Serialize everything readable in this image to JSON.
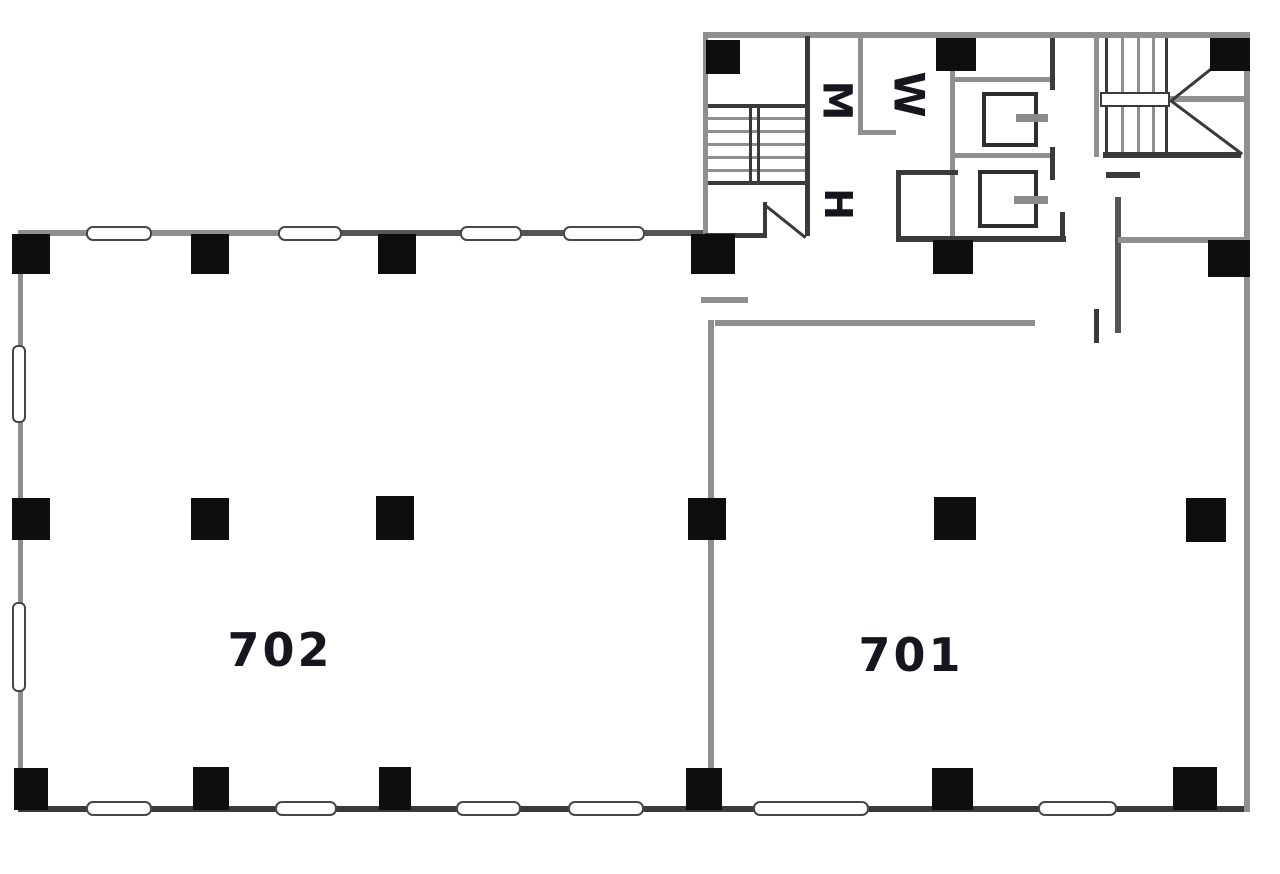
{
  "title": "Office floor plan — 7th floor",
  "rooms": {
    "left_room_label": "702",
    "right_room_label": "701",
    "mens_room_label": "M",
    "womens_room_label": "W",
    "utility_room_label": "H"
  },
  "colors": {
    "background": "#ffffff",
    "column_black": "#0e0e0e",
    "g": "#8f8f8f",
    "m": "#555555",
    "d": "#3a3a3a",
    "text": "#16161f"
  },
  "plan": {
    "walls": [
      [
        18,
        230,
        326,
        6,
        "g"
      ],
      [
        340,
        230,
        368,
        6,
        "m"
      ],
      [
        703,
        32,
        547,
        6,
        "g"
      ],
      [
        18,
        232,
        5,
        580,
        "g"
      ],
      [
        18,
        806,
        1232,
        6,
        "d"
      ],
      [
        1244,
        34,
        6,
        778,
        "g"
      ],
      [
        703,
        36,
        5,
        202,
        "g"
      ],
      [
        805,
        36,
        5,
        200,
        "d"
      ],
      [
        705,
        233,
        62,
        5,
        "d"
      ],
      [
        708,
        104,
        97,
        4,
        "d"
      ],
      [
        708,
        117,
        97,
        3,
        "g"
      ],
      [
        708,
        130,
        97,
        3,
        "g"
      ],
      [
        708,
        143,
        97,
        3,
        "g"
      ],
      [
        708,
        156,
        97,
        3,
        "g"
      ],
      [
        708,
        169,
        97,
        3,
        "g"
      ],
      [
        708,
        181,
        97,
        4,
        "d"
      ],
      [
        749,
        104,
        3,
        81,
        "d"
      ],
      [
        757,
        104,
        3,
        81,
        "d"
      ],
      [
        763,
        202,
        4,
        36,
        "d"
      ],
      [
        858,
        37,
        5,
        98,
        "g"
      ],
      [
        858,
        130,
        38,
        5,
        "g"
      ],
      [
        950,
        70,
        5,
        170,
        "g"
      ],
      [
        955,
        77,
        98,
        5,
        "g"
      ],
      [
        1050,
        38,
        5,
        52,
        "d"
      ],
      [
        955,
        153,
        98,
        5,
        "g"
      ],
      [
        1050,
        147,
        5,
        33,
        "d"
      ],
      [
        896,
        170,
        62,
        5,
        "d"
      ],
      [
        896,
        170,
        5,
        72,
        "d"
      ],
      [
        896,
        236,
        170,
        6,
        "d"
      ],
      [
        1060,
        212,
        5,
        30,
        "d"
      ],
      [
        1094,
        35,
        5,
        122,
        "g"
      ],
      [
        1105,
        38,
        3,
        116,
        "d"
      ],
      [
        1121,
        38,
        3,
        116,
        "g"
      ],
      [
        1137,
        38,
        3,
        116,
        "g"
      ],
      [
        1152,
        38,
        3,
        116,
        "g"
      ],
      [
        1165,
        38,
        3,
        116,
        "d"
      ],
      [
        1170,
        96,
        76,
        6,
        "g"
      ],
      [
        1103,
        152,
        138,
        6,
        "d"
      ],
      [
        1106,
        172,
        34,
        6,
        "d"
      ],
      [
        1115,
        197,
        6,
        136,
        "m"
      ],
      [
        1118,
        237,
        128,
        6,
        "g"
      ],
      [
        1094,
        309,
        5,
        34,
        "d"
      ],
      [
        715,
        320,
        320,
        6,
        "g"
      ],
      [
        708,
        320,
        6,
        452,
        "g"
      ],
      [
        701,
        297,
        47,
        6,
        "g"
      ]
    ],
    "columns": [
      [
        12,
        234,
        38,
        40
      ],
      [
        191,
        234,
        38,
        40
      ],
      [
        378,
        234,
        38,
        40
      ],
      [
        691,
        234,
        44,
        40
      ],
      [
        933,
        240,
        40,
        34
      ],
      [
        1208,
        240,
        42,
        37
      ],
      [
        12,
        498,
        38,
        42
      ],
      [
        191,
        498,
        38,
        42
      ],
      [
        376,
        496,
        38,
        44
      ],
      [
        688,
        498,
        38,
        42
      ],
      [
        934,
        497,
        42,
        43
      ],
      [
        1186,
        498,
        40,
        44
      ],
      [
        14,
        768,
        34,
        42
      ],
      [
        193,
        767,
        36,
        43
      ],
      [
        379,
        767,
        32,
        43
      ],
      [
        686,
        768,
        36,
        42
      ],
      [
        932,
        768,
        41,
        42
      ],
      [
        1173,
        767,
        44,
        43
      ],
      [
        706,
        40,
        34,
        34
      ],
      [
        936,
        38,
        40,
        33
      ],
      [
        1210,
        38,
        40,
        33
      ]
    ],
    "windows_h": [
      [
        86,
        226,
        62
      ],
      [
        278,
        226,
        60
      ],
      [
        460,
        226,
        58
      ],
      [
        563,
        226,
        78
      ],
      [
        86,
        801,
        62
      ],
      [
        275,
        801,
        58
      ],
      [
        456,
        801,
        61
      ],
      [
        568,
        801,
        72
      ],
      [
        753,
        801,
        112
      ],
      [
        1038,
        801,
        75
      ]
    ],
    "windows_v": [
      [
        12,
        345,
        74
      ],
      [
        12,
        602,
        86
      ]
    ],
    "stalls": [
      [
        982,
        92,
        48,
        47
      ],
      [
        978,
        170,
        52,
        50
      ]
    ],
    "fixtures": [
      [
        1016,
        114,
        32,
        8
      ],
      [
        1014,
        196,
        34,
        8
      ]
    ],
    "landing": [
      1100,
      92,
      66,
      11
    ],
    "diagonals": [
      [
        766,
        204,
        52,
        38.7,
        "d"
      ],
      [
        1171,
        99,
        92,
        -38.5,
        "d"
      ],
      [
        1171,
        99,
        90,
        36.8,
        "d"
      ]
    ],
    "texts": [
      {
        "t": "702",
        "n": "room-702-label",
        "x": 280,
        "y": 651,
        "s": 46,
        "rot": 0,
        "w": 400,
        "sp": 3
      },
      {
        "t": "701",
        "n": "room-701-label",
        "x": 911,
        "y": 656,
        "s": 46,
        "rot": 0,
        "w": 400,
        "sp": 3
      },
      {
        "t": "M",
        "n": "mens-room-label",
        "x": 836,
        "y": 101,
        "s": 40,
        "rot": 90,
        "w": 600,
        "sp": 0
      },
      {
        "t": "W",
        "n": "womens-room-label",
        "x": 909,
        "y": 95,
        "s": 42,
        "rot": 90,
        "w": 600,
        "sp": 0
      },
      {
        "t": "H",
        "n": "utility-room-label",
        "x": 838,
        "y": 205,
        "s": 38,
        "rot": 90,
        "w": 600,
        "sp": 0
      }
    ]
  }
}
